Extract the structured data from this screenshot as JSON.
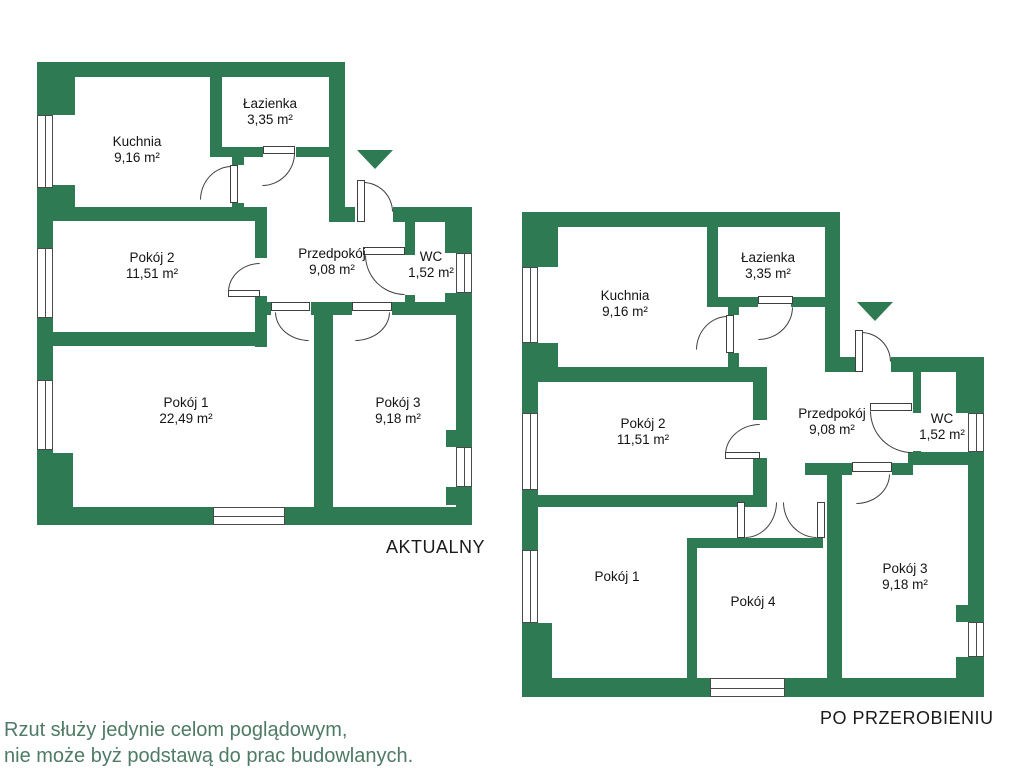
{
  "plan1": {
    "title": "AKTUALNY",
    "rooms": {
      "kuchnia": {
        "name": "Kuchnia",
        "area": "9,16 m²"
      },
      "lazienka": {
        "name": "Łazienka",
        "area": "3,35 m²"
      },
      "pokoj2": {
        "name": "Pokój 2",
        "area": "11,51 m²"
      },
      "przedpokoj": {
        "name": "Przedpokój",
        "area": "9,08 m²"
      },
      "wc": {
        "name": "WC",
        "area": "1,52 m²"
      },
      "pokoj1": {
        "name": "Pokój 1",
        "area": "22,49 m²"
      },
      "pokoj3": {
        "name": "Pokój 3",
        "area": "9,18 m²"
      }
    }
  },
  "plan2": {
    "title": "PO PRZEROBIENIU",
    "rooms": {
      "kuchnia": {
        "name": "Kuchnia",
        "area": "9,16 m²"
      },
      "lazienka": {
        "name": "Łazienka",
        "area": "3,35 m²"
      },
      "pokoj2": {
        "name": "Pokój 2",
        "area": "11,51 m²"
      },
      "przedpokoj": {
        "name": "Przedpokój",
        "area": "9,08 m²"
      },
      "wc": {
        "name": "WC",
        "area": "1,52 m²"
      },
      "pokoj1": {
        "name": "Pokój 1",
        "area": ""
      },
      "pokoj4": {
        "name": "Pokój 4",
        "area": ""
      },
      "pokoj3": {
        "name": "Pokój 3",
        "area": "9,18 m²"
      }
    }
  },
  "disclaimer": {
    "line1": "Rzut służy jedynie celom poglądowym,",
    "line2": "nie może byż podstawą do prac budowlanych."
  },
  "colors": {
    "wall": "#2e7a53",
    "disclaimer_text": "#4e7b65",
    "label_text": "#141414"
  }
}
